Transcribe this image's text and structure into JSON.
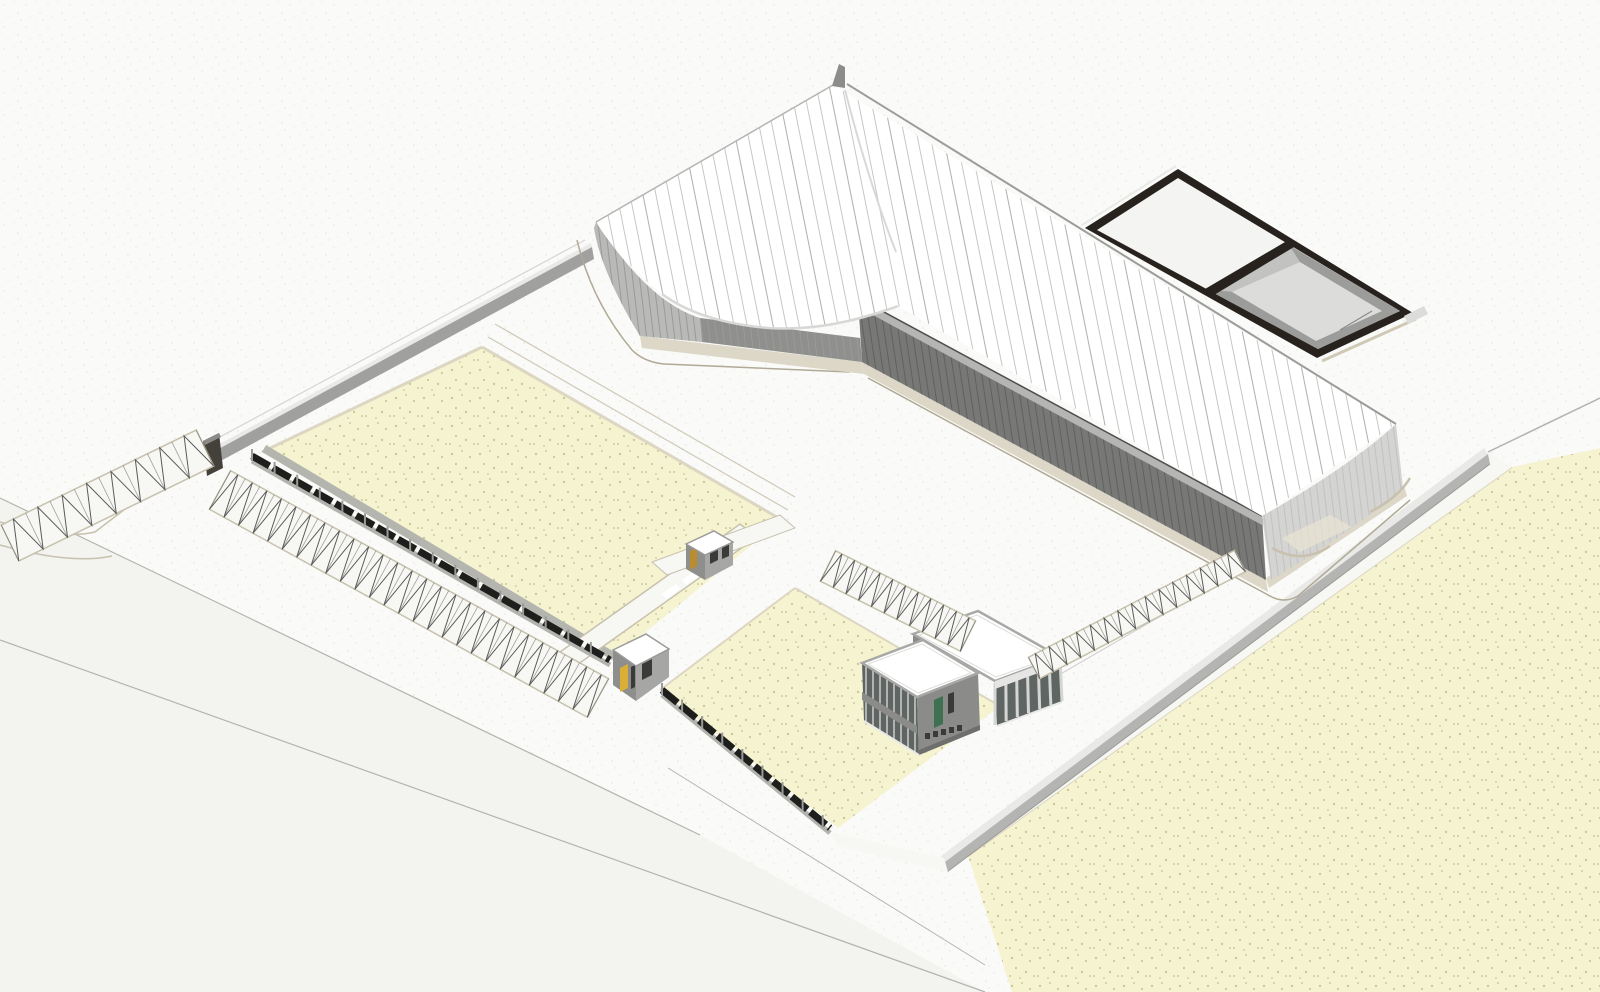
{
  "scene": {
    "type": "architectural-axonometric-site-model",
    "objects": [
      "warehouse-building",
      "warehouse-roof",
      "rooftop-courtyard-frame",
      "office-building",
      "guard-booth-main-gate",
      "guard-booth-yard",
      "site-fence",
      "boundary-wall",
      "lawn-field-northwest",
      "lawn-field-central",
      "lawn-field-southeast",
      "street-parking-northwest",
      "street-parking-west",
      "parking-island-central",
      "parking-row-east",
      "perimeter-road",
      "gate-walkway",
      "curb-arcs"
    ]
  },
  "colors": {
    "bg": "#fafaf8",
    "bg_dot": "#e4e4e0",
    "road": "#f3f3f0",
    "road_line": "#b3b3b0",
    "field": "#f6f3d0",
    "field_dot1": "#ccc79c",
    "field_dot2": "#b3ae85",
    "field_curb": "#dcd6c2",
    "walk": "#f7f7f4",
    "curb_tan": "#c7c1ae",
    "apron_tan": "#eae4d2",
    "roof": "#ffffff",
    "seam": "#c7c7c5",
    "seam_dark": "#aeaeac",
    "fascia": "#9c9c9a",
    "ridge_crease": "#d8d8d6",
    "apex_fin": "#8c8c8a",
    "wall_dark": "#787876",
    "wall_dark_stripe": "#616160",
    "wall_mid": "#8f8f8d",
    "wall_end": "#b9b9b7",
    "wall_light": "#d4d4d2",
    "wall_light_stripe": "#c2c2c0",
    "wall_fascia_band": "#b5b5b3",
    "roof_shadow_line": "#4e4e4c",
    "plinth": "#dcd7c7",
    "plinth_edge": "#b0a995",
    "frame_dark": "#27221d",
    "frame_inner_white": "#f4f4f2",
    "pit_wall": "#9c9c9a",
    "pit_wall_light": "#c2c2c0",
    "pit_floor": "#dcdcda",
    "frame_rim_beige": "#cfc9b6",
    "frame_tab": "#dcdcda",
    "bwall_face": "#b4b4b2",
    "bwall_face_nw": "#a0a09e",
    "bwall_top": "#e9e9e7",
    "gate_post": "#44403a",
    "gate_post_top": "#8a8a88",
    "fence_dark": "#1e1e1c",
    "fence_post": "#9a9a98",
    "fence_base": "#b2b2ae",
    "mow_strip": "#b5b5b0",
    "stall_line": "#5a5a58",
    "glass": "#5f6563",
    "mullion": "#d5d5d3",
    "office_wall": "#8b8b89",
    "office_parapet_line": "#a8a8a6",
    "office_parapet_inner": "#dcdcda",
    "office_spandrel": "#e5e5e3",
    "office_base_dark": "#6e6e6c",
    "door_green": "#3f7050",
    "door_yellow": "#d9af36",
    "door_tan": "#b98c2f",
    "window_dark": "#3a3a38",
    "booth_wall": "#8e8e8c",
    "booth_wall2": "#a6a6a4",
    "booth_roof_edge": "#9a9a98",
    "sidewalk_line": "#cfc9b8",
    "drive_line": "#cdcdcb"
  },
  "params": {
    "seam_spacing": 13,
    "seam_tilt": 0.2,
    "wall_stripe_spacing": 7,
    "office_mullion_spacing": 7,
    "colonnade_columns": 6,
    "fence_post_spacing": 26,
    "fence_panel_dash": "20,4",
    "parking_rows": [
      {
        "name": "street-parking-northwest",
        "x1": 10,
        "y1": 543,
        "x2": 205,
        "y2": 448,
        "w": 40,
        "stalls": 8
      },
      {
        "name": "street-parking-west",
        "x1": 220,
        "y1": 490,
        "x2": 598,
        "y2": 698,
        "w": 44,
        "stalls": 26
      },
      {
        "name": "parking-island-central",
        "x1": 828,
        "y1": 566,
        "x2": 968,
        "y2": 636,
        "w": 34,
        "stalls": 11
      },
      {
        "name": "parking-row-east",
        "x1": 1034,
        "y1": 668,
        "x2": 1240,
        "y2": 561,
        "w": 24,
        "stalls": 15
      }
    ],
    "fences": [
      {
        "name": "site-fence-northwest",
        "x1": 252,
        "y1": 458,
        "x2": 610,
        "y2": 662
      },
      {
        "name": "site-fence-southwest",
        "x1": 662,
        "y1": 692,
        "x2": 830,
        "y2": 830
      }
    ]
  }
}
